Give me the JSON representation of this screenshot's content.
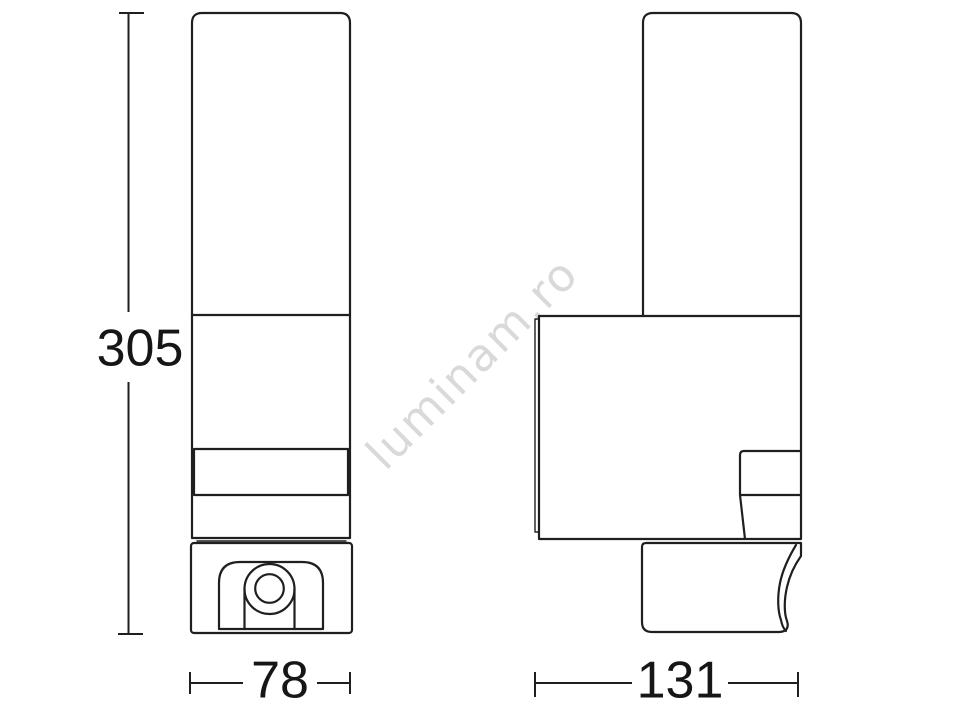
{
  "watermark": {
    "text": "luminam.ro",
    "color": "#d9d9d9"
  },
  "style": {
    "line_color": "#1f1f1f",
    "label_color": "#161616",
    "background_color": "#ffffff"
  },
  "dimensions": {
    "height": {
      "value": "305"
    },
    "width": {
      "value": "78"
    },
    "depth": {
      "value": "131"
    }
  }
}
